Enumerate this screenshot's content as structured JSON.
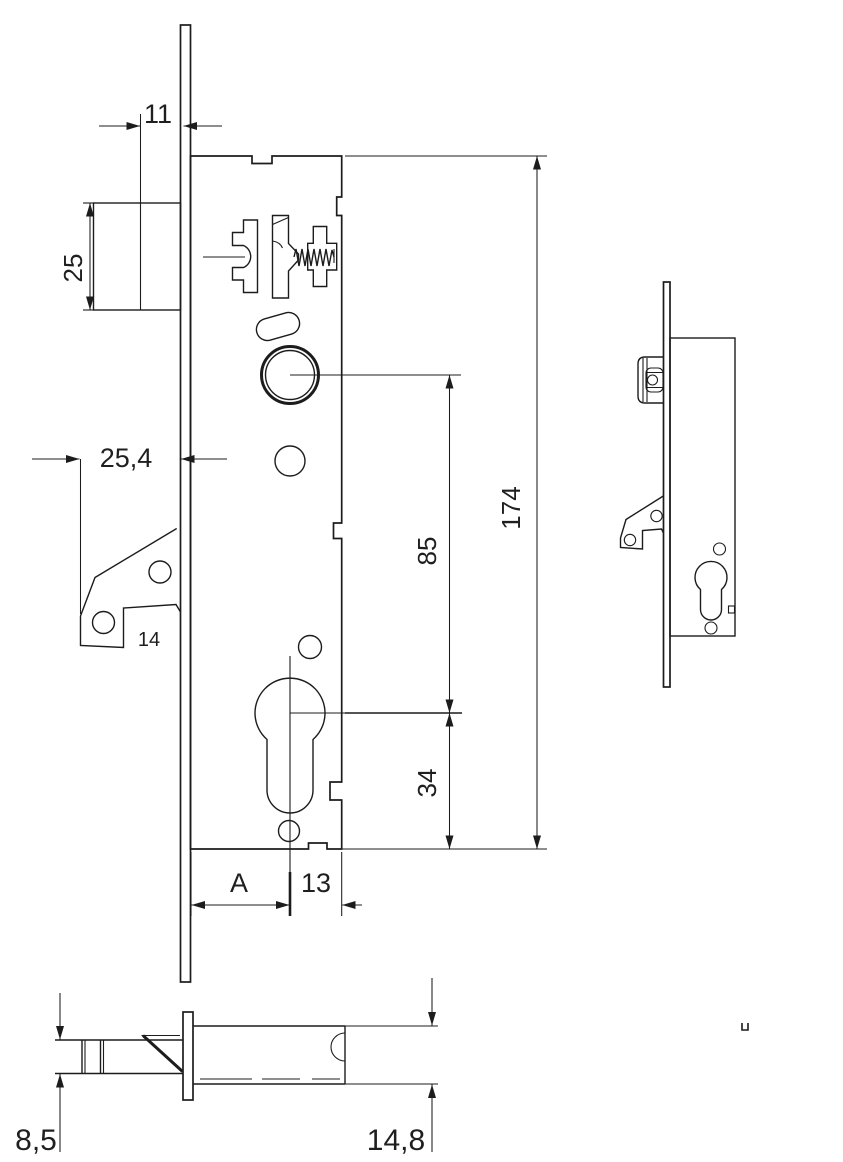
{
  "drawing": {
    "subject": "mortise-lock-dimension-drawing",
    "colors": {
      "line": "#1c1c1c",
      "background": "#ffffff"
    }
  },
  "dimensions": {
    "latch_projection": "11",
    "latch_height": "25",
    "faceplate_offset": "25,4",
    "bracket_note": "14",
    "backset_variable": "A",
    "edge_to_center": "13",
    "follower_to_cylinder": "85",
    "case_height": "174",
    "cylinder_to_bottom": "34",
    "latch_width": "8,5",
    "case_depth": "14,8"
  }
}
